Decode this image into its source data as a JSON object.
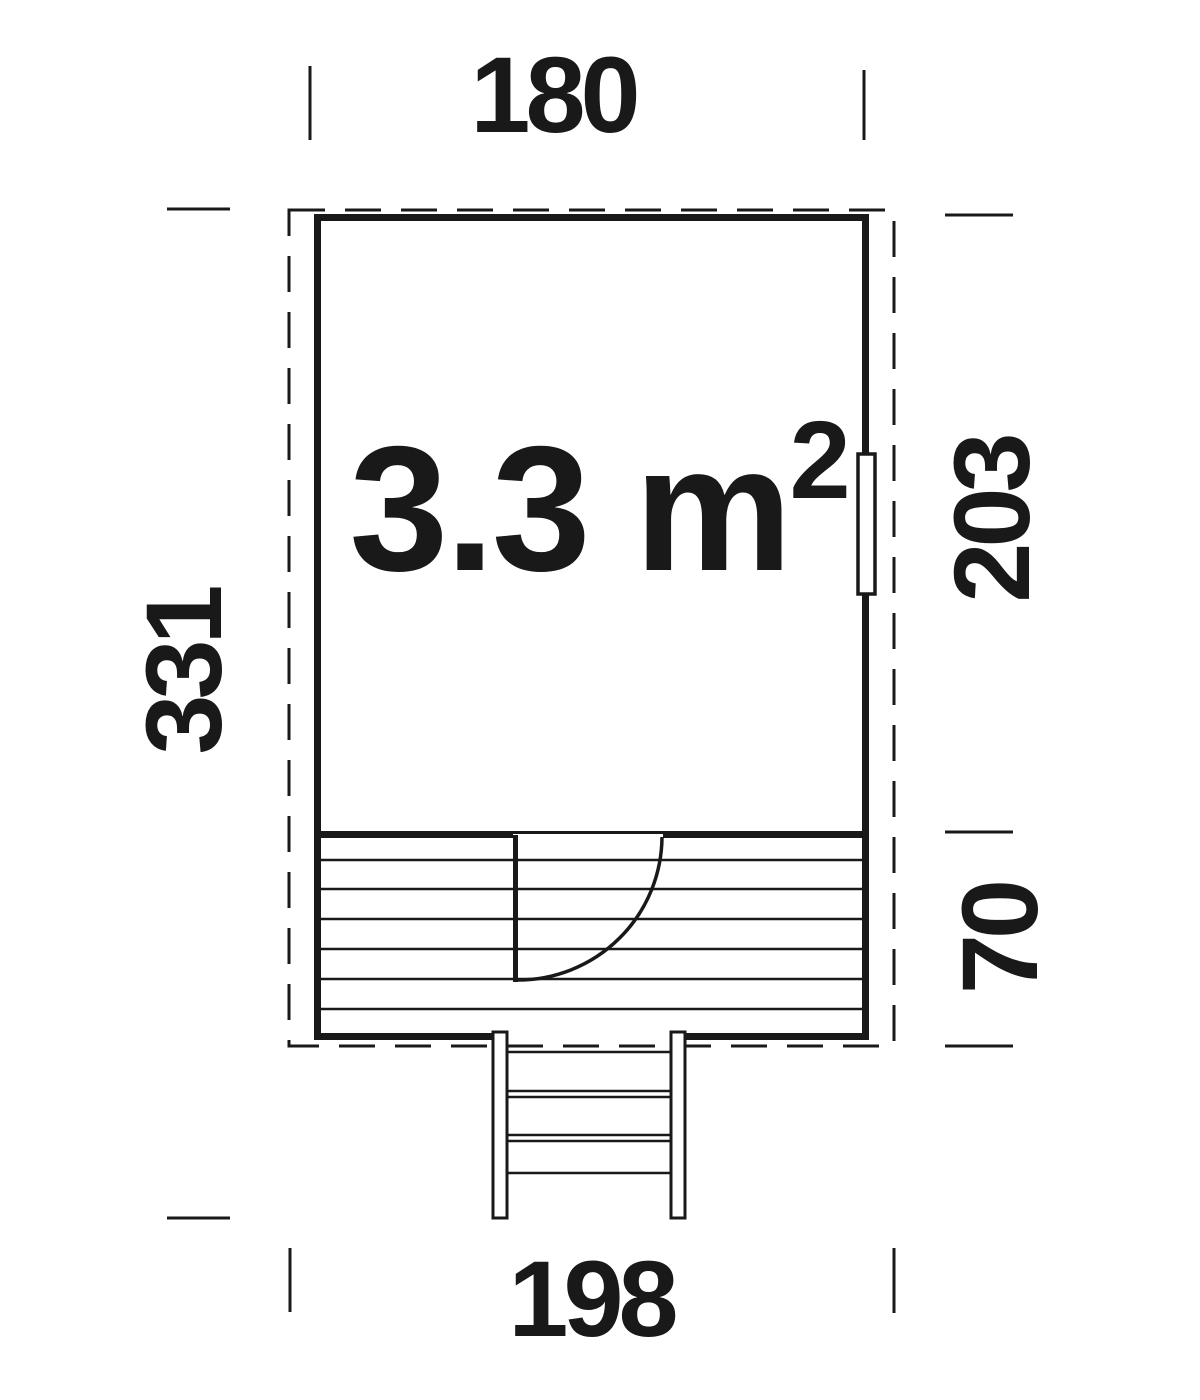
{
  "drawing": {
    "type": "floor-plan",
    "area_label": {
      "value": "3.3 m",
      "superscript": "2"
    },
    "dimensions": {
      "top_width": "180",
      "left_total_depth": "331",
      "right_room_depth": "203",
      "right_terrace_depth": "70",
      "bottom_width": "198"
    },
    "features": {
      "window": "right-wall-window",
      "door": "terrace-door-with-swing-arc",
      "terrace": "planked-deck",
      "steps": "front-steps"
    },
    "colors": {
      "line": "#191919",
      "background": "#ffffff"
    }
  }
}
